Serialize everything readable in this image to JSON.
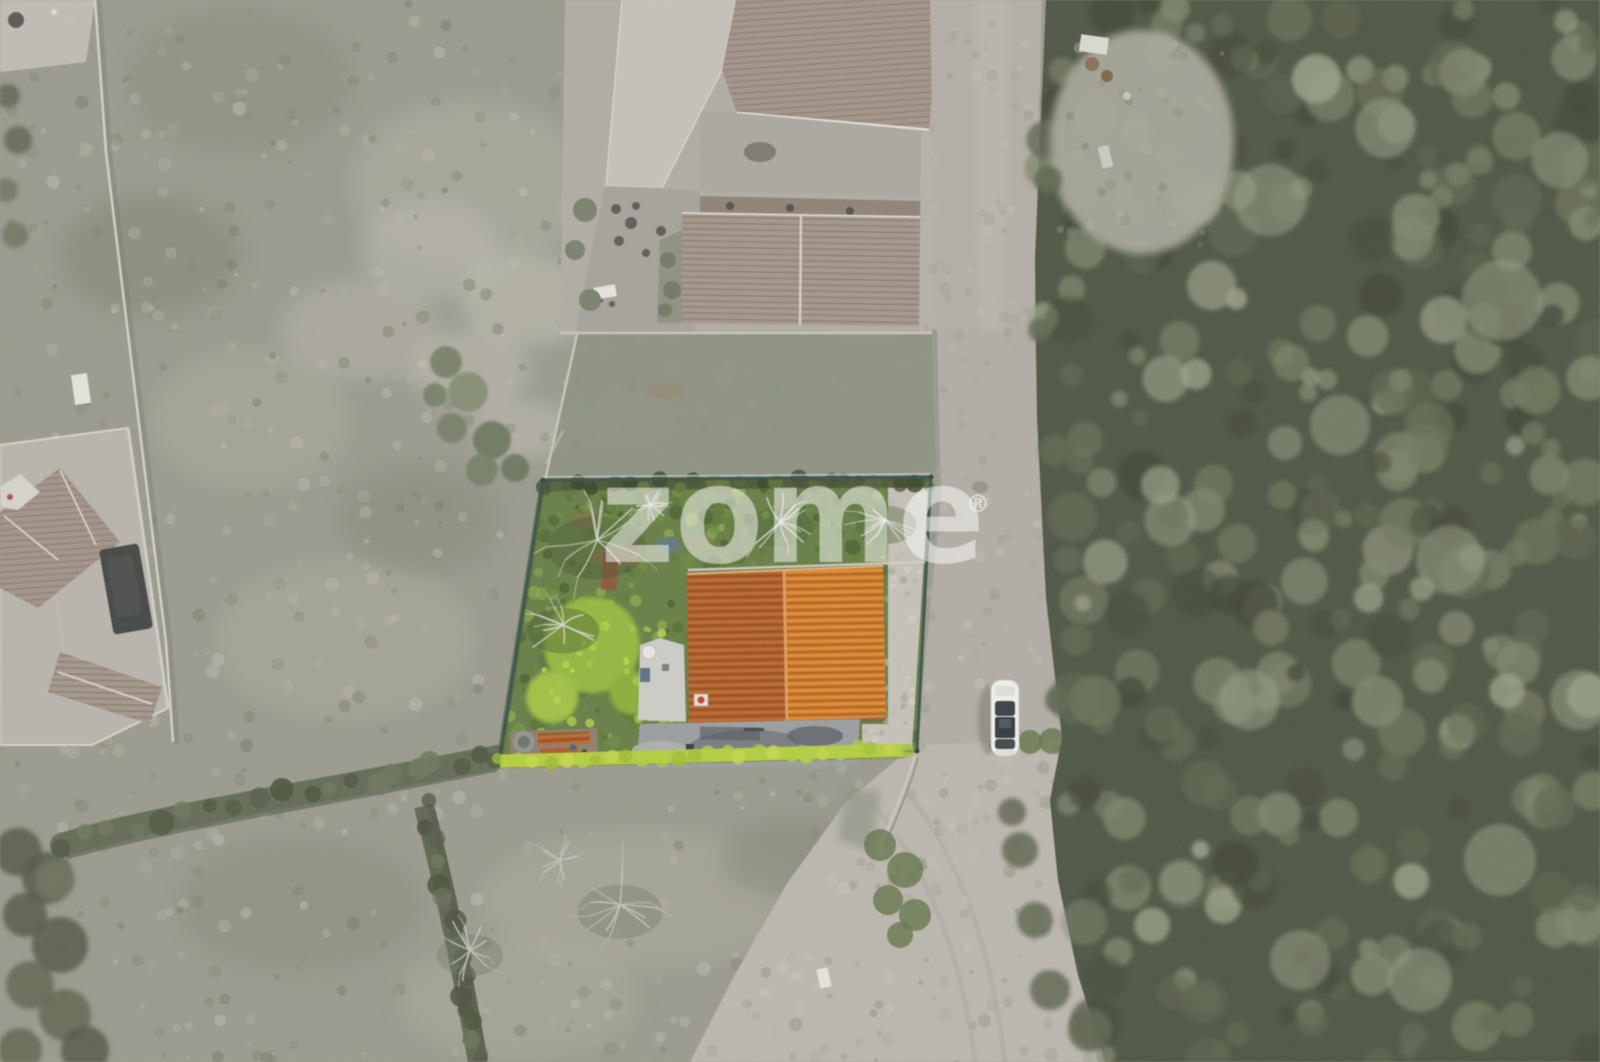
{
  "image": {
    "kind": "aerial-drone-photograph",
    "subject": "top-down view of a property lot highlighted in colour amid a desaturated landscape",
    "elements": [
      "highlighted plot with garden and bare trees",
      "orange tiled gable roof house",
      "grey terrace",
      "neighbouring buildings",
      "gravel road",
      "white car",
      "woodland",
      "hedgerows",
      "grass fields",
      "dirt path"
    ]
  },
  "watermark": {
    "text": "zome",
    "registered_mark": "®",
    "color": "#ffffff"
  },
  "palette": {
    "field_base": "#98988b",
    "field_light": "#aeac9e",
    "field_pale": "#c2bfb3",
    "field_dark": "#79816e",
    "forest_base": "#474f3c",
    "forest_dark": "#39402e",
    "forest_mid": "#59624a",
    "forest_light": "#7b8468",
    "forest_pale": "#98a086",
    "road": "#b3aea5",
    "road_light": "#c0bbb2",
    "gravel": "#c6c2b8",
    "building_flat": "#c6c2ba",
    "building_tile": "#a29186",
    "courtyard": "#aba79e",
    "dark_roof": "#3c403d",
    "plot_green": "#627a3e",
    "plot_green_dark": "#47602a",
    "plot_green_bright": "#8fb636",
    "bush_bright": "#9dc23c",
    "hedge_bright": "#b7cf37",
    "hedge_row": "#5e6750",
    "soil_brown": "#8b7148",
    "branch_light": "#d7dacf",
    "roof_orange": "#d77a1f",
    "roof_orange_dark": "#b2591e",
    "annex_white": "#cfcec8",
    "terrace_plot": "#999da0",
    "terrace_dark": "#5a6065",
    "boundary": "#2e4a47",
    "car_white": "#f4f4f0",
    "car_glass": "#33383d",
    "watermark": "#ffffff"
  }
}
